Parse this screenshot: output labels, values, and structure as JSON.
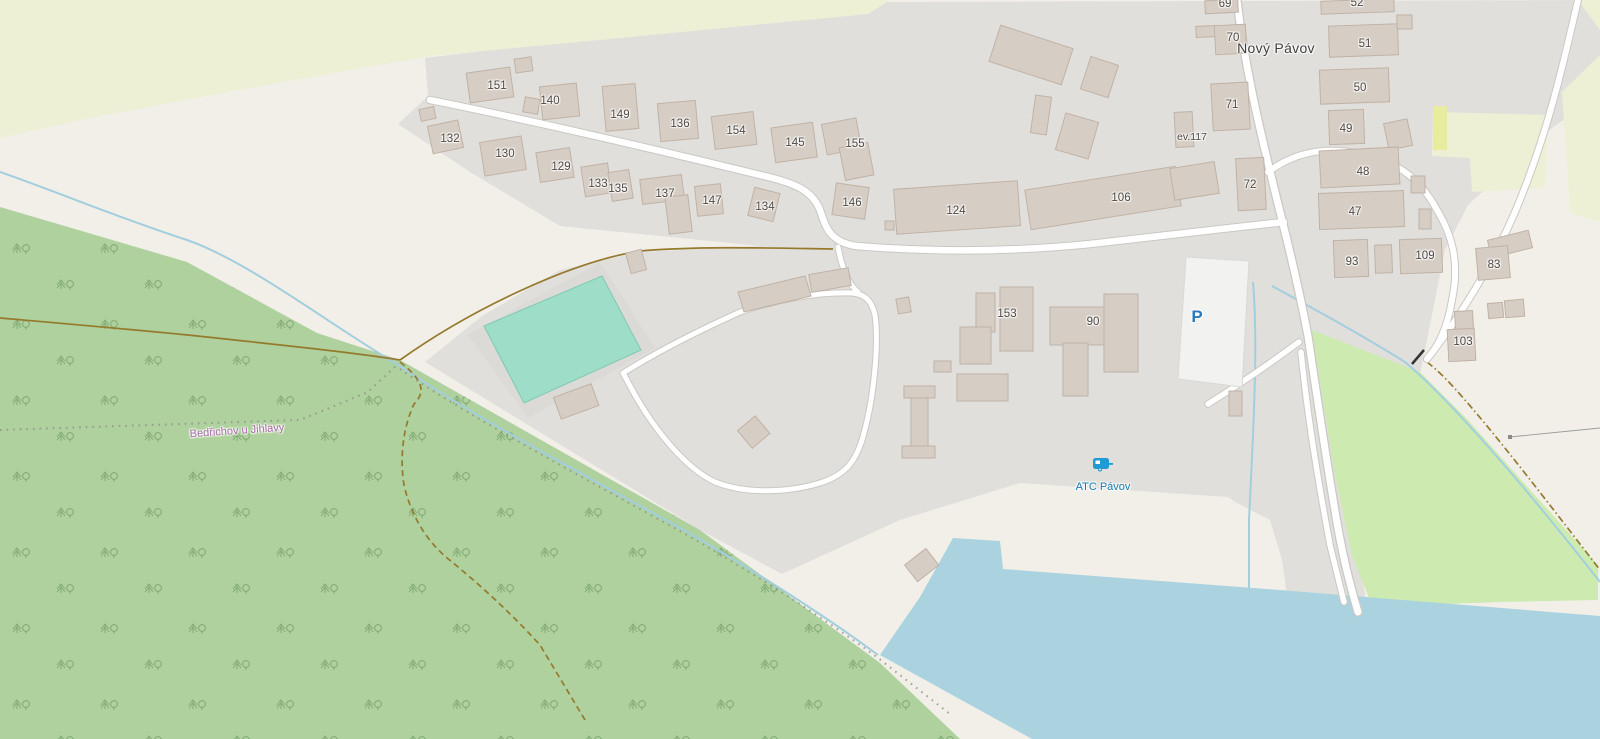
{
  "map": {
    "place_label": "Nový Pávov",
    "place_label_pos": {
      "x": 1276,
      "y": 48
    },
    "boundary_label": "Bedřichov u Jihlavy",
    "boundary_label_pos": {
      "x": 237,
      "y": 431
    },
    "campsite": {
      "label": "ATC Pávov",
      "icon": "caravan-icon",
      "label_pos": {
        "x": 1103,
        "y": 487
      },
      "icon_pos": {
        "x": 1103,
        "y": 465
      }
    },
    "parking": {
      "label": "P",
      "pos": {
        "x": 1197,
        "y": 317
      }
    },
    "ev_label": {
      "text": "ev.117",
      "x": 1192,
      "y": 137
    },
    "house_numbers": [
      {
        "text": "151",
        "x": 497,
        "y": 86
      },
      {
        "text": "140",
        "x": 550,
        "y": 101
      },
      {
        "text": "149",
        "x": 620,
        "y": 115
      },
      {
        "text": "136",
        "x": 680,
        "y": 124
      },
      {
        "text": "154",
        "x": 736,
        "y": 131
      },
      {
        "text": "145",
        "x": 795,
        "y": 143
      },
      {
        "text": "155",
        "x": 855,
        "y": 144
      },
      {
        "text": "132",
        "x": 450,
        "y": 139
      },
      {
        "text": "130",
        "x": 505,
        "y": 154
      },
      {
        "text": "129",
        "x": 561,
        "y": 167
      },
      {
        "text": "133",
        "x": 598,
        "y": 184
      },
      {
        "text": "135",
        "x": 618,
        "y": 189
      },
      {
        "text": "137",
        "x": 665,
        "y": 194
      },
      {
        "text": "147",
        "x": 712,
        "y": 201
      },
      {
        "text": "134",
        "x": 765,
        "y": 207
      },
      {
        "text": "146",
        "x": 852,
        "y": 203
      },
      {
        "text": "124",
        "x": 956,
        "y": 211
      },
      {
        "text": "106",
        "x": 1121,
        "y": 198
      },
      {
        "text": "72",
        "x": 1250,
        "y": 185
      },
      {
        "text": "69",
        "x": 1225,
        "y": 4
      },
      {
        "text": "70",
        "x": 1233,
        "y": 38
      },
      {
        "text": "71",
        "x": 1232,
        "y": 105
      },
      {
        "text": "52",
        "x": 1357,
        "y": 3
      },
      {
        "text": "51",
        "x": 1365,
        "y": 44
      },
      {
        "text": "50",
        "x": 1360,
        "y": 88
      },
      {
        "text": "49",
        "x": 1346,
        "y": 129
      },
      {
        "text": "48",
        "x": 1363,
        "y": 172
      },
      {
        "text": "47",
        "x": 1355,
        "y": 212
      },
      {
        "text": "93",
        "x": 1352,
        "y": 262
      },
      {
        "text": "109",
        "x": 1425,
        "y": 256
      },
      {
        "text": "83",
        "x": 1494,
        "y": 265
      },
      {
        "text": "103",
        "x": 1463,
        "y": 342
      },
      {
        "text": "153",
        "x": 1007,
        "y": 314
      },
      {
        "text": "90",
        "x": 1093,
        "y": 322
      }
    ],
    "colors": {
      "background": "#f2efe9",
      "residential": "#e1dfdc",
      "farmland": "#eef0d5",
      "forest": "#aed19d",
      "grass": "#cdebb0",
      "water": "#aad3df",
      "pool": "#9edec8",
      "building": "#d6cec5",
      "building_outline": "#c0b2a5",
      "road": "#ffffff",
      "road_casing": "#cac8c3",
      "track": "#957a2d",
      "stream": "#a3cede",
      "boundary_label_color": "#a86ba8",
      "amenity_blue": "#147cb0",
      "parking_blue": "#2a79ba"
    }
  }
}
